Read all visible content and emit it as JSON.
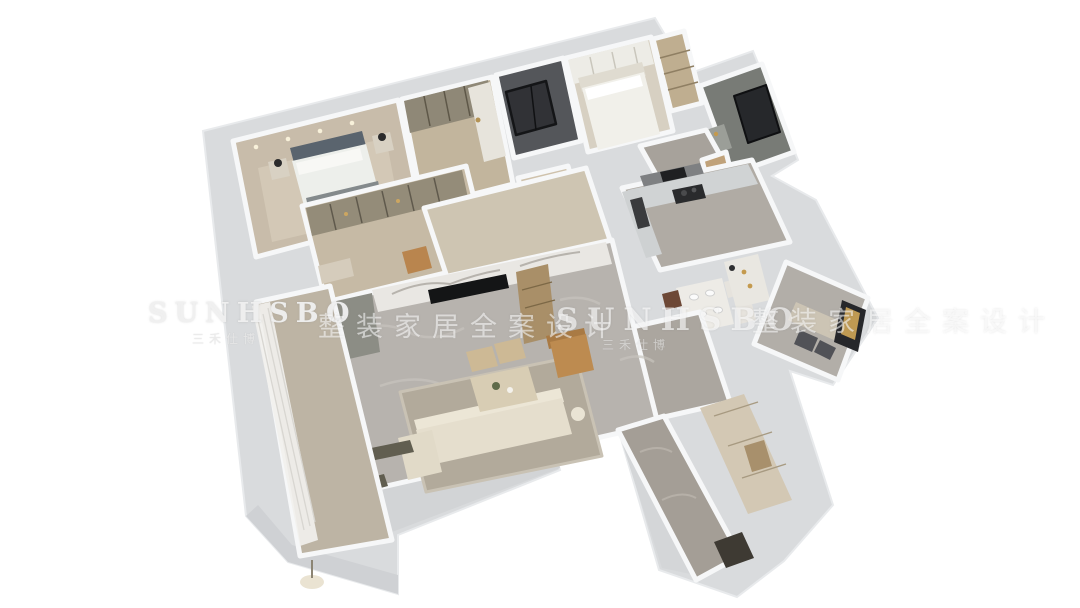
{
  "scene": {
    "type": "3d-isometric-apartment-floorplan-render",
    "background": "#ffffff",
    "palette": {
      "outer_wall": "#d9dbdd",
      "wall_top_highlight": "#f6f7f8",
      "marble_floor_gray": "#b7b3ae",
      "corridor_beige": "#cec5b2",
      "bedroom_beige": "#c8bcaa",
      "dark_elevator": "#54565a",
      "bathroom_gray": "#787b76",
      "sofa_cream": "#e5decd",
      "accent_tan": "#bd8b50",
      "tv_black": "#141516",
      "gold_accent": "#c49a4e",
      "kitchen_counter": "#d0d3d4",
      "entry_cabinet": "#d3c8b4"
    }
  },
  "watermarks": {
    "brand": "SUNHSBO",
    "brand_sub": "三禾仕博",
    "tagline": "整装家居全案设计"
  }
}
